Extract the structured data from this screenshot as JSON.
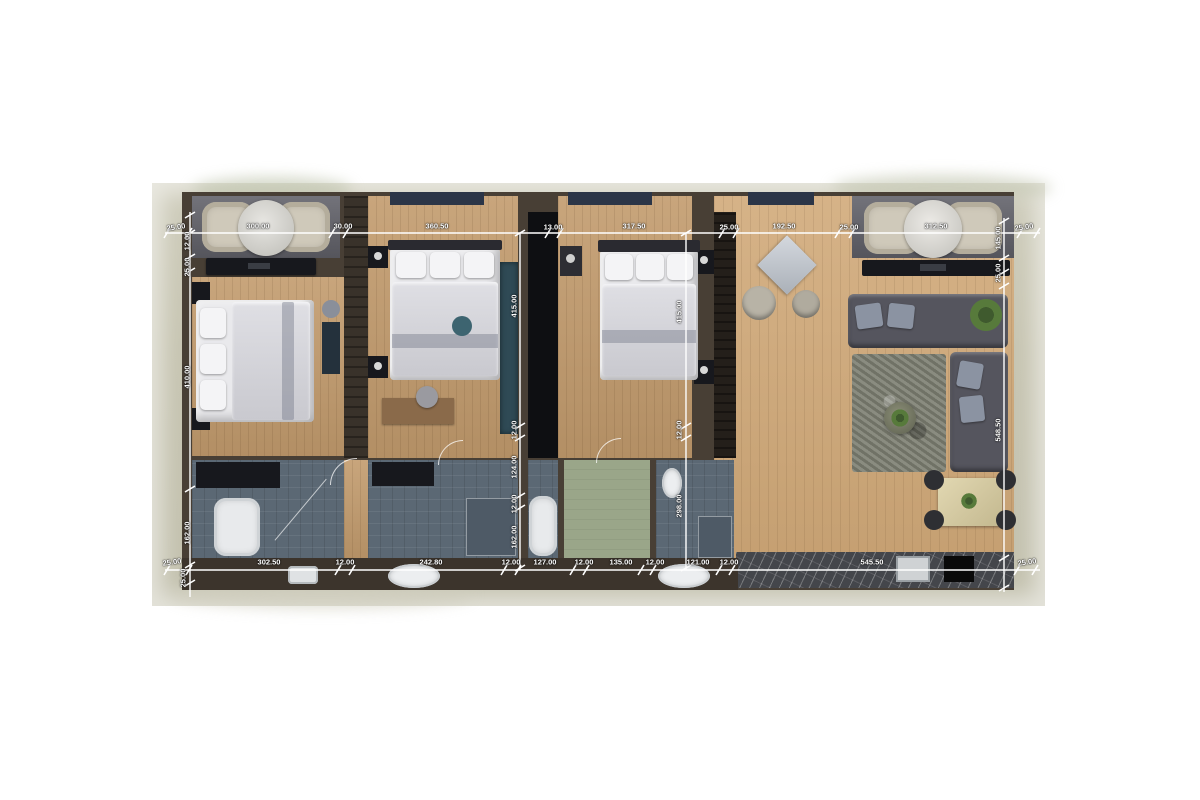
{
  "image": {
    "description": "3D rendered apartment floor plan, top view, with white dimension lines"
  },
  "palette": {
    "page_background": "#ffffff",
    "photo_background": "#c7c5b2",
    "wall": "#483f35",
    "wood_floor": "#c29b6d",
    "living_wood_floor": "#d0a877",
    "bathroom_tile": "#5b6874",
    "green_room": "#9aa689",
    "terrace": "#63636b",
    "dimension_line": "#ffffff"
  },
  "dimension_groups": {
    "top_edge": [
      "25.00",
      "300.00",
      "30.00",
      "360.50",
      "13.00",
      "317.50",
      "25.00",
      "192.50",
      "25.00",
      "312.50",
      "25.00"
    ],
    "bottom_edge": [
      "25.00",
      "302.50",
      "12.00",
      "242.80",
      "12.00",
      "127.00",
      "12.00",
      "135.00",
      "12.00",
      "121.00",
      "12.00",
      "545.50",
      "25.00"
    ],
    "left_edge": [
      "12.00",
      "25.00",
      "410.00",
      "162.00",
      "25.00"
    ],
    "inner_line_1": [
      "415.00",
      "12.00",
      "124.00",
      "12.00",
      "162.00"
    ],
    "inner_line_2": [
      "415.00",
      "12.00",
      "298.00"
    ],
    "right_edge": [
      "145.00",
      "25.00",
      "548.50"
    ]
  },
  "labels": [
    {
      "text": "25.00",
      "x": 176,
      "y": 227,
      "rot": -8
    },
    {
      "text": "300.00",
      "x": 258,
      "y": 226,
      "rot": 0
    },
    {
      "text": "30.00",
      "x": 343,
      "y": 226,
      "rot": 0
    },
    {
      "text": "360.50",
      "x": 437,
      "y": 226,
      "rot": 0
    },
    {
      "text": "13.00",
      "x": 553,
      "y": 227,
      "rot": 0
    },
    {
      "text": "317.50",
      "x": 634,
      "y": 226,
      "rot": 0
    },
    {
      "text": "25.00",
      "x": 729,
      "y": 227,
      "rot": 0
    },
    {
      "text": "192.50",
      "x": 784,
      "y": 226,
      "rot": 0
    },
    {
      "text": "25.00",
      "x": 849,
      "y": 227,
      "rot": 0
    },
    {
      "text": "312.50",
      "x": 936,
      "y": 226,
      "rot": 0
    },
    {
      "text": "25.00",
      "x": 1024,
      "y": 227,
      "rot": -8
    },
    {
      "text": "25.00",
      "x": 172,
      "y": 562,
      "rot": -8
    },
    {
      "text": "302.50",
      "x": 269,
      "y": 562,
      "rot": 0
    },
    {
      "text": "12.00",
      "x": 345,
      "y": 562,
      "rot": 0
    },
    {
      "text": "242.80",
      "x": 431,
      "y": 562,
      "rot": 0
    },
    {
      "text": "12.00",
      "x": 511,
      "y": 562,
      "rot": 0
    },
    {
      "text": "127.00",
      "x": 545,
      "y": 562,
      "rot": 0
    },
    {
      "text": "12.00",
      "x": 584,
      "y": 562,
      "rot": 0
    },
    {
      "text": "135.00",
      "x": 621,
      "y": 562,
      "rot": 0
    },
    {
      "text": "12.00",
      "x": 655,
      "y": 562,
      "rot": 0
    },
    {
      "text": "121.00",
      "x": 698,
      "y": 562,
      "rot": 0
    },
    {
      "text": "12.00",
      "x": 729,
      "y": 562,
      "rot": 0
    },
    {
      "text": "545.50",
      "x": 872,
      "y": 562,
      "rot": 0
    },
    {
      "text": "25.00",
      "x": 1027,
      "y": 562,
      "rot": -8
    },
    {
      "text": "12.00",
      "x": 187,
      "y": 241,
      "rot": -90
    },
    {
      "text": "25.00",
      "x": 187,
      "y": 267,
      "rot": -90
    },
    {
      "text": "410.00",
      "x": 187,
      "y": 377,
      "rot": -90
    },
    {
      "text": "162.00",
      "x": 187,
      "y": 533,
      "rot": -90
    },
    {
      "text": "25.00",
      "x": 183,
      "y": 578,
      "rot": -90
    },
    {
      "text": "415.00",
      "x": 514,
      "y": 306,
      "rot": -90
    },
    {
      "text": "12.00",
      "x": 514,
      "y": 430,
      "rot": -90
    },
    {
      "text": "124.00",
      "x": 514,
      "y": 467,
      "rot": -90
    },
    {
      "text": "12.00",
      "x": 514,
      "y": 504,
      "rot": -90
    },
    {
      "text": "162.00",
      "x": 514,
      "y": 537,
      "rot": -90
    },
    {
      "text": "415.00",
      "x": 679,
      "y": 312,
      "rot": -90
    },
    {
      "text": "12.00",
      "x": 679,
      "y": 430,
      "rot": -90
    },
    {
      "text": "298.00",
      "x": 679,
      "y": 506,
      "rot": -90
    },
    {
      "text": "145.00",
      "x": 998,
      "y": 238,
      "rot": -90
    },
    {
      "text": "25.00",
      "x": 998,
      "y": 273,
      "rot": -90
    },
    {
      "text": "548.50",
      "x": 998,
      "y": 430,
      "rot": -90
    }
  ]
}
